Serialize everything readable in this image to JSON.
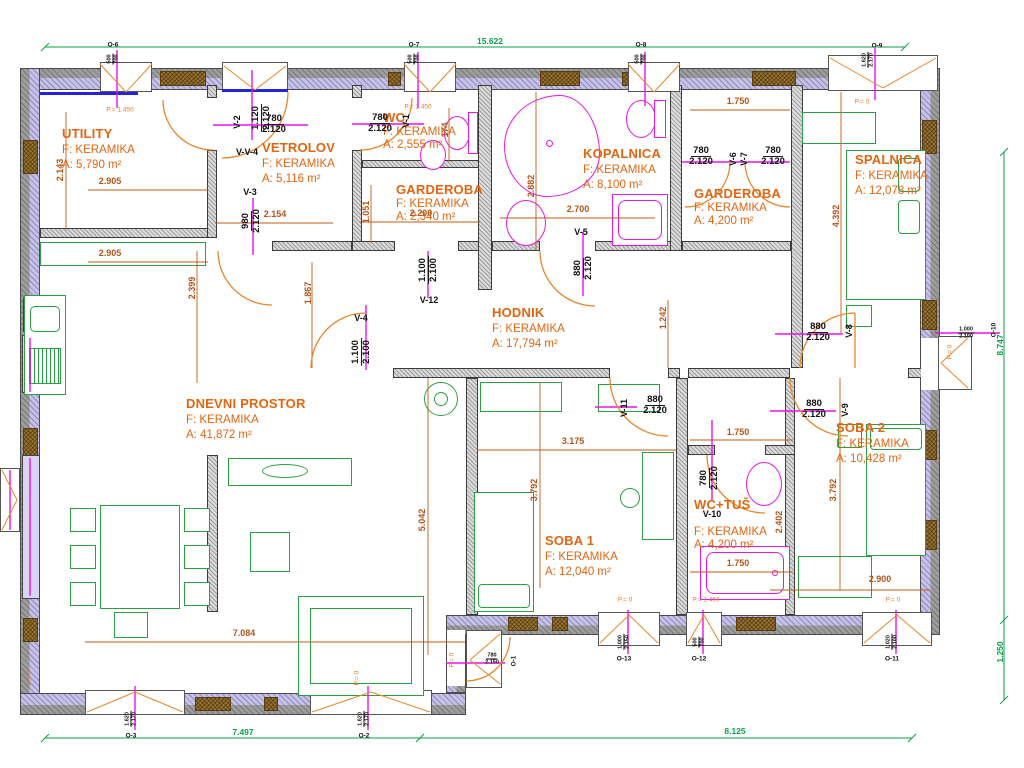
{
  "colors": {
    "room_label_orange": "#e4650f",
    "dim_orange": "#b3541a",
    "dim_green": "#0aa14a",
    "door_line_magenta": "#ee10ee",
    "arc_orange": "#e8872a",
    "wall_insulation_lavender": "#c6c0ee",
    "threshold_blue": "#2323de"
  },
  "rooms": {
    "utility": {
      "name": "UTILITY",
      "floor": "F: KERAMIKA",
      "area": "A: 5,790 m²"
    },
    "vetrolov": {
      "name": "VETROLOV",
      "floor": "F: KERAMIKA",
      "area": "A: 5,116 m²"
    },
    "wc": {
      "name": "WC",
      "floor": "F: KERAMIKA",
      "area": "A: 2,555 m²"
    },
    "garderoba1": {
      "name": "GARDEROBA",
      "floor": "F: KERAMIKA",
      "area": "A: 2,340 m²"
    },
    "kopalnica": {
      "name": "KOPALNICA",
      "floor": "F: KERAMIKA",
      "area": "A: 8,100 m²"
    },
    "garderoba2": {
      "name": "GARDEROBA",
      "floor": "F: KERAMIKA",
      "area": "A: 4,200 m²"
    },
    "spalnica": {
      "name": "SPALNICA",
      "floor": "F: KERAMIKA",
      "area": "A: 12,078 m²"
    },
    "hodnik": {
      "name": "HODNIK",
      "floor": "F: KERAMIKA",
      "area": "A: 17,794 m²"
    },
    "dnevni": {
      "name": "DNEVNI PROSTOR",
      "floor": "F: KERAMIKA",
      "area": "A: 41,872 m²"
    },
    "soba1": {
      "name": "SOBA 1",
      "floor": "F: KERAMIKA",
      "area": "A: 12,040 m²"
    },
    "soba2": {
      "name": "SOBA 2",
      "floor": "F: KERAMIKA",
      "area": "A: 10,428 m²"
    },
    "wctus": {
      "name": "WC+TUŠ",
      "floor": "F: KERAMIKA",
      "area": "A: 4,200 m²"
    }
  },
  "doors": [
    {
      "id": "v1",
      "label": "V-1",
      "w": "780",
      "h": "2.120",
      "fx": 380,
      "fy": 124,
      "frot": 0,
      "tx": 406,
      "ty": 121,
      "trot": 90
    },
    {
      "id": "v2",
      "label": "V-2",
      "w": "780",
      "h": "2.120",
      "fx": 274,
      "fy": 125,
      "frot": 0,
      "tx": 237,
      "ty": 122,
      "trot": 90
    },
    {
      "id": "v3",
      "label": "V-3",
      "w": "980",
      "h": "2.120",
      "fx": 252,
      "fy": 221,
      "frot": 90,
      "tx": 250,
      "ty": 192,
      "trot": 0
    },
    {
      "id": "v4",
      "label": "V-4",
      "w": "1.100",
      "h": "2.100",
      "fx": 362,
      "fy": 352,
      "frot": 90,
      "tx": 361,
      "ty": 318,
      "trot": 0
    },
    {
      "id": "v5",
      "label": "V-5",
      "w": "880",
      "h": "2.120",
      "fx": 584,
      "fy": 268,
      "frot": 90,
      "tx": 581,
      "ty": 232,
      "trot": 0
    },
    {
      "id": "v6",
      "label": "V-6",
      "w": "780",
      "h": "2.120",
      "fx": 701,
      "fy": 157,
      "frot": 0,
      "tx": 733,
      "ty": 159,
      "trot": 90
    },
    {
      "id": "v7",
      "label": "V-7",
      "w": "780",
      "h": "2.120",
      "fx": 773,
      "fy": 157,
      "frot": 0,
      "tx": 744,
      "ty": 159,
      "trot": 90
    },
    {
      "id": "v8",
      "label": "V-8",
      "w": "880",
      "h": "2.120",
      "fx": 818,
      "fy": 333,
      "frot": 0,
      "tx": 849,
      "ty": 331,
      "trot": 90
    },
    {
      "id": "v9",
      "label": "V-9",
      "w": "880",
      "h": "2.120",
      "fx": 814,
      "fy": 410,
      "frot": 0,
      "tx": 845,
      "ty": 410,
      "trot": 90
    },
    {
      "id": "v10",
      "label": "V-10",
      "w": "780",
      "h": "2.120",
      "fx": 710,
      "fy": 478,
      "frot": 90,
      "tx": 712,
      "ty": 514,
      "trot": 0
    },
    {
      "id": "v11",
      "label": "V-11",
      "w": "880",
      "h": "2.120",
      "fx": 655,
      "fy": 406,
      "frot": 0,
      "tx": 624,
      "ty": 408,
      "trot": 90
    },
    {
      "id": "v12",
      "label": "V-12",
      "w": "1.100",
      "h": "2.100",
      "fx": 429,
      "fy": 270,
      "frot": 90,
      "tx": 429,
      "ty": 300,
      "trot": 0
    },
    {
      "id": "vv4",
      "label": "V-V-4",
      "w": "1.120",
      "h": "2.120",
      "fx": 262,
      "fy": 118,
      "frot": 90,
      "tx": 247,
      "ty": 152,
      "trot": 0
    }
  ],
  "windows": [
    {
      "id": "o1",
      "label": "O-1",
      "w": "780",
      "h": "2.150",
      "fx": 492,
      "fy": 659,
      "frot": 0,
      "tx": 514,
      "ty": 661,
      "trot": 90
    },
    {
      "id": "o2",
      "label": "O-2",
      "w": "1.620",
      "h": "2.170",
      "fx": 364,
      "fy": 719,
      "frot": 90,
      "tx": 364,
      "ty": 736,
      "trot": 0
    },
    {
      "id": "o3",
      "label": "O-3",
      "w": "1.620",
      "h": "2.170",
      "fx": 131,
      "fy": 719,
      "frot": 90,
      "tx": 131,
      "ty": 736,
      "trot": 0
    },
    {
      "id": "o6",
      "label": "O-6",
      "w": "500",
      "h": "700",
      "fx": 113,
      "fy": 59,
      "frot": 90,
      "tx": 113,
      "ty": 45,
      "trot": 0
    },
    {
      "id": "o7",
      "label": "O-7",
      "w": "500",
      "h": "700",
      "fx": 414,
      "fy": 59,
      "frot": 90,
      "tx": 414,
      "ty": 45,
      "trot": 0
    },
    {
      "id": "o8",
      "label": "O-8",
      "w": "500",
      "h": "700",
      "fx": 641,
      "fy": 59,
      "frot": 90,
      "tx": 641,
      "ty": 45,
      "trot": 0
    },
    {
      "id": "o9",
      "label": "O-9",
      "w": "1.620",
      "h": "2.170",
      "fx": 868,
      "fy": 60,
      "frot": 90,
      "tx": 877,
      "ty": 46,
      "trot": 0
    },
    {
      "id": "o10",
      "label": "O-10",
      "w": "1.000",
      "h": "2.100",
      "fx": 966,
      "fy": 333,
      "frot": 0,
      "tx": 994,
      "ty": 330,
      "trot": 90
    },
    {
      "id": "o11",
      "label": "O-11",
      "w": "1.020",
      "h": "2.100",
      "fx": 892,
      "fy": 642,
      "frot": 90,
      "tx": 892,
      "ty": 659,
      "trot": 0
    },
    {
      "id": "o12",
      "label": "O-12",
      "w": "500",
      "h": "700",
      "fx": 699,
      "fy": 642,
      "frot": 90,
      "tx": 699,
      "ty": 659,
      "trot": 0
    },
    {
      "id": "o13",
      "label": "O-13",
      "w": "1.000",
      "h": "2.150",
      "fx": 624,
      "fy": 642,
      "frot": 90,
      "tx": 624,
      "ty": 659,
      "trot": 0
    }
  ],
  "dims_orange": [
    {
      "t": "2.143",
      "x": 60,
      "y": 170,
      "rot": 90
    },
    {
      "t": "2.905",
      "x": 110,
      "y": 181,
      "rot": 0
    },
    {
      "t": "2.905",
      "x": 110,
      "y": 253,
      "rot": 0
    },
    {
      "t": "2.399",
      "x": 192,
      "y": 288,
      "rot": 90
    },
    {
      "t": "1.867",
      "x": 308,
      "y": 293,
      "rot": 90
    },
    {
      "t": "2.154",
      "x": 275,
      "y": 214,
      "rot": 0
    },
    {
      "t": "1.051",
      "x": 366,
      "y": 212,
      "rot": 90
    },
    {
      "t": "2.200",
      "x": 421,
      "y": 213,
      "rot": 0
    },
    {
      "t": "174",
      "x": 445,
      "y": 130,
      "rot": 90
    },
    {
      "t": "2.700",
      "x": 578,
      "y": 209,
      "rot": 0
    },
    {
      "t": "2.882",
      "x": 531,
      "y": 186,
      "rot": 90
    },
    {
      "t": "1.750",
      "x": 738,
      "y": 101,
      "rot": 0
    },
    {
      "t": "4.392",
      "x": 836,
      "y": 216,
      "rot": 90
    },
    {
      "t": "1.242",
      "x": 663,
      "y": 318,
      "rot": 90
    },
    {
      "t": "3.175",
      "x": 573,
      "y": 441,
      "rot": 0
    },
    {
      "t": "3.792",
      "x": 534,
      "y": 490,
      "rot": 90
    },
    {
      "t": "3.792",
      "x": 833,
      "y": 490,
      "rot": 90
    },
    {
      "t": "5.042",
      "x": 422,
      "y": 520,
      "rot": 90
    },
    {
      "t": "7.084",
      "x": 244,
      "y": 633,
      "rot": 0
    },
    {
      "t": "2.900",
      "x": 880,
      "y": 579,
      "rot": 0
    },
    {
      "t": "2.402",
      "x": 779,
      "y": 522,
      "rot": 90
    },
    {
      "t": "1.750",
      "x": 738,
      "y": 432,
      "rot": 0
    },
    {
      "t": "1.750",
      "x": 738,
      "y": 563,
      "rot": 0
    }
  ],
  "dims_green": [
    {
      "t": "15.622",
      "x": 490,
      "y": 41,
      "rot": 0
    },
    {
      "t": "7.497",
      "x": 243,
      "y": 732,
      "rot": 0
    },
    {
      "t": "8.125",
      "x": 735,
      "y": 731,
      "rot": 0
    },
    {
      "t": "8.747",
      "x": 1000,
      "y": 345,
      "rot": 90
    },
    {
      "t": "1.250",
      "x": 1000,
      "y": 652,
      "rot": 90
    }
  ],
  "sills": [
    {
      "t": "P.= 1.450",
      "x": 120,
      "y": 110,
      "rot": 0
    },
    {
      "t": "P.= 1.450",
      "x": 418,
      "y": 107,
      "rot": 0
    },
    {
      "t": "P.= 1.450",
      "x": 706,
      "y": 600,
      "rot": 0
    },
    {
      "t": "P.= 0",
      "x": 862,
      "y": 102,
      "rot": 0
    },
    {
      "t": "P.= 0",
      "x": 950,
      "y": 352,
      "rot": 90
    },
    {
      "t": "P.= 0",
      "x": 893,
      "y": 600,
      "rot": 0
    },
    {
      "t": "P.= 0",
      "x": 625,
      "y": 600,
      "rot": 0
    },
    {
      "t": "P.= 0",
      "x": 452,
      "y": 660,
      "rot": 90
    },
    {
      "t": "P.= 0",
      "x": 357,
      "y": 678,
      "rot": 90
    },
    {
      "t": "P.= 0",
      "x": 30,
      "y": 678,
      "rot": 90
    }
  ]
}
